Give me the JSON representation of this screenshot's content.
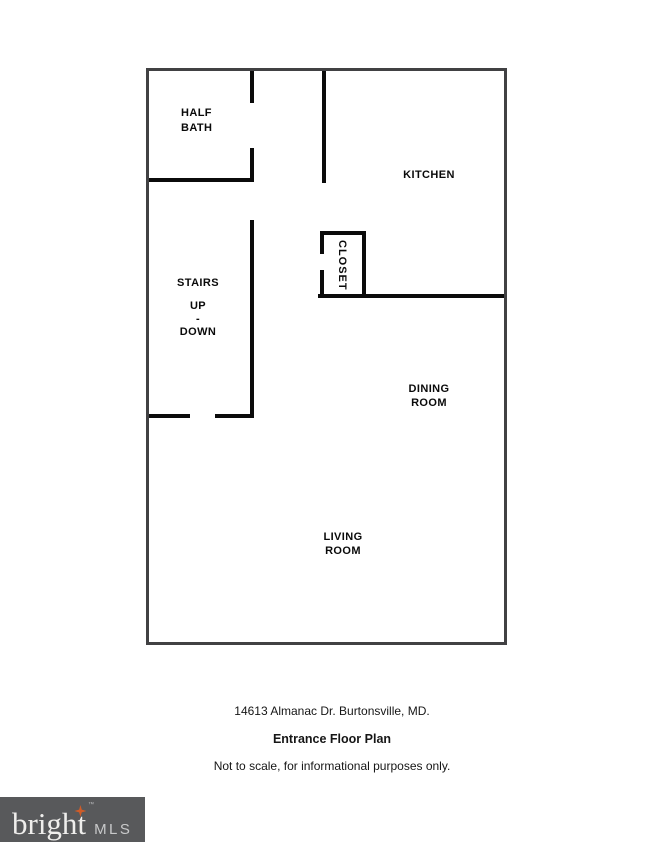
{
  "floor_plan": {
    "rooms": {
      "half_bath": {
        "lines": [
          "HALF",
          "BATH"
        ]
      },
      "kitchen": {
        "label": "KITCHEN"
      },
      "stairs": {
        "lines": [
          "STAIRS",
          "UP",
          "-",
          "DOWN"
        ]
      },
      "closet": {
        "label": "CLOSET"
      },
      "dining_room": {
        "lines": [
          "DINING",
          "ROOM"
        ]
      },
      "living_room": {
        "lines": [
          "LIVING",
          "ROOM"
        ]
      }
    }
  },
  "captions": {
    "address": "14613 Almanac Dr. Burtonsville, MD.",
    "plan_title": "Entrance Floor Plan",
    "disclaimer": "Not to scale, for informational purposes only."
  },
  "logo": {
    "brand_prefix": "brigh",
    "brand_last": "t",
    "trademark": "™",
    "suffix": "MLS"
  },
  "colors": {
    "outer_wall": "#414143",
    "inner_wall": "#0b0b0b",
    "logo_background": "#58595b",
    "logo_star": "#cf5c28",
    "logo_brand_text": "#efeeec",
    "logo_suffix_text": "#c8c9ca"
  }
}
